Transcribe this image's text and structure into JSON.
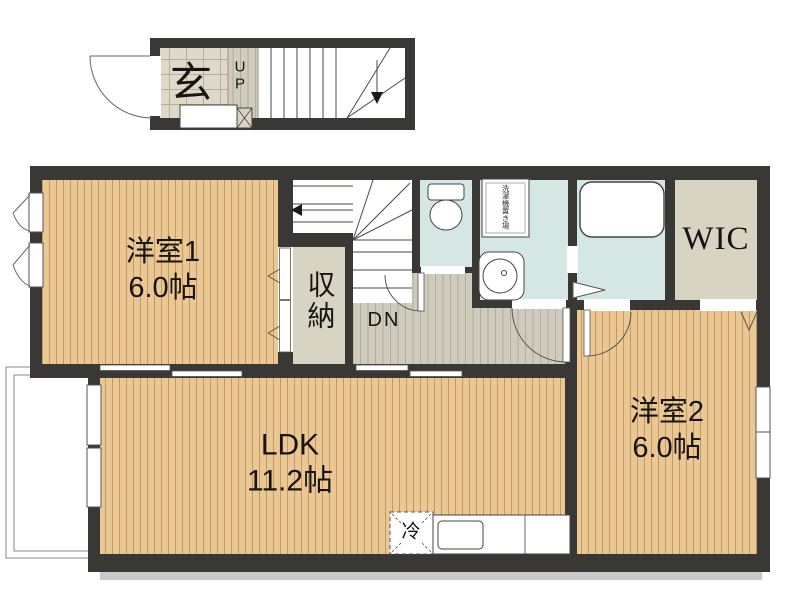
{
  "rooms": {
    "room1": {
      "name": "洋室1",
      "size": "6.0帖"
    },
    "room2": {
      "name": "洋室2",
      "size": "6.0帖"
    },
    "ldk": {
      "name": "LDK",
      "size": "11.2帖"
    },
    "wic": {
      "name": "WIC"
    },
    "storage": {
      "name": "収納"
    },
    "entrance": {
      "name": "玄"
    }
  },
  "stairs": {
    "up": "UP",
    "down": "DN"
  },
  "kitchen": {
    "fridge": "冷"
  },
  "laundry": {
    "label": "洗濯機置き場"
  },
  "colors": {
    "wall": "#3a3834",
    "wood": "#ebc893",
    "wood_line": "#c09a61",
    "hall": "#cfcbbd",
    "tile": "#ded9c8",
    "wet": "#d5e7e5",
    "closet": "#d8d4c3",
    "background": "#ffffff"
  }
}
